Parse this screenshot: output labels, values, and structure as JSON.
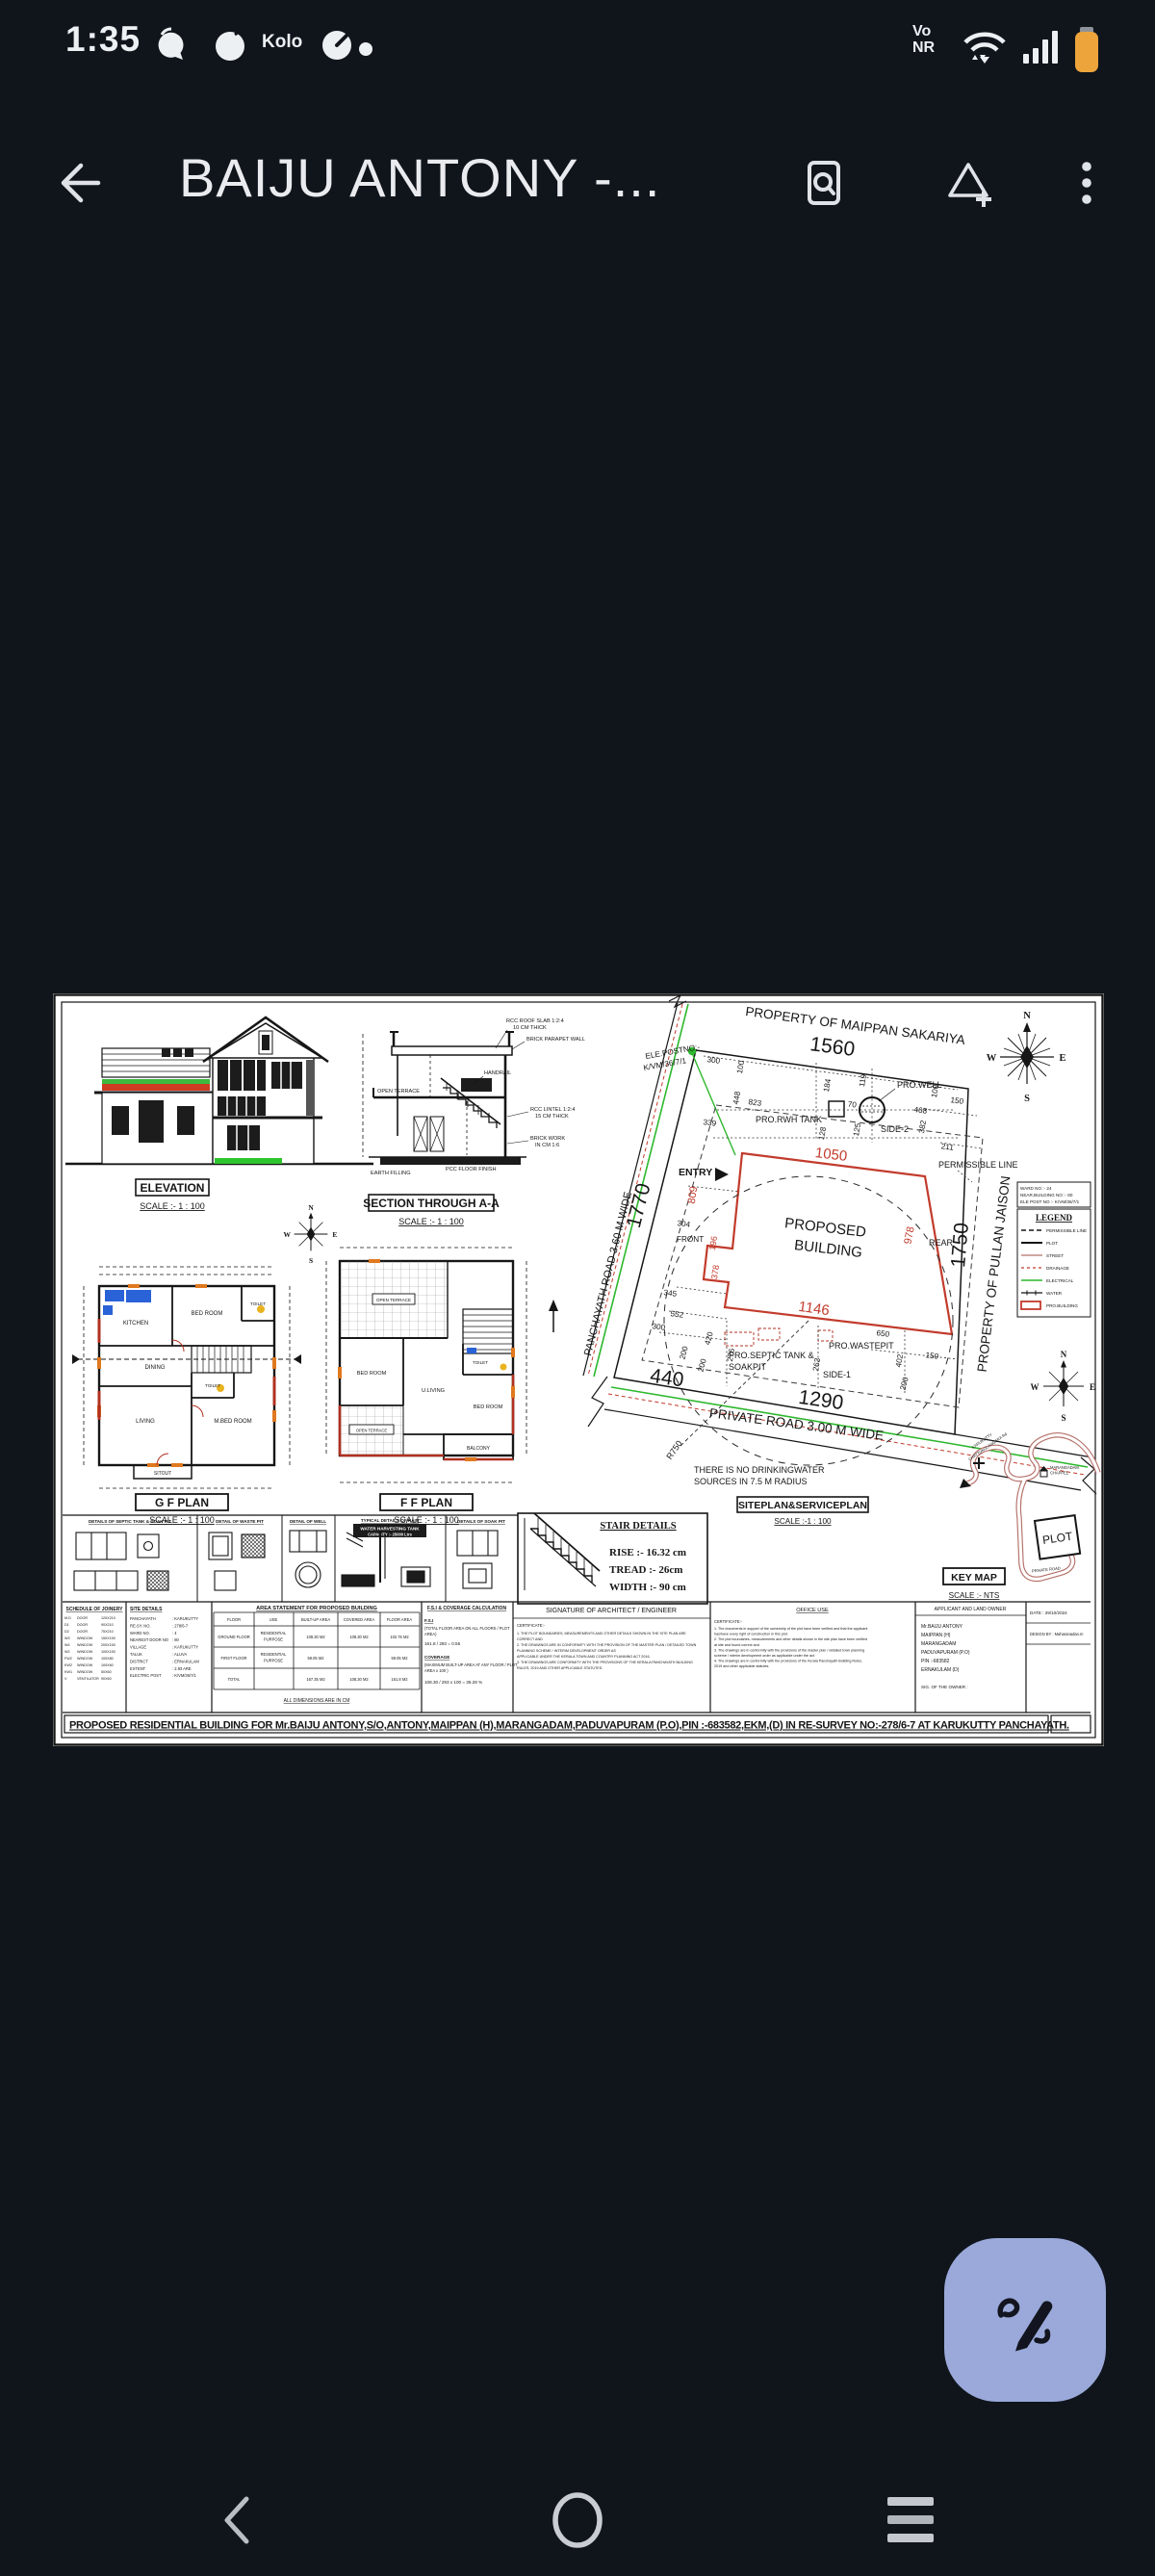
{
  "status_bar": {
    "time": "1:35",
    "carrier": "Kolo",
    "net1": "Vo",
    "net2": "NR"
  },
  "app_bar": {
    "title": "BAIJU ANTONY -..."
  },
  "compass": {
    "n": "N",
    "e": "E",
    "w": "W",
    "s": "S"
  },
  "sheet": {
    "el": {
      "title": "ELEVATION",
      "scale": "SCALE :- 1 : 100"
    },
    "sec": {
      "title": "SECTION THROUGH A-A",
      "scale": "SCALE :- 1 : 100",
      "a_roof1": "RCC ROOF SLAB 1:2:4",
      "a_roof2": "10 CM THICK",
      "a_par": "BRICK PARAPET WALL",
      "a_ter": "OPEN TERRACE",
      "a_hand": "HANDRAIL",
      "a_lin1": "RCC LINTEL 1:2:4",
      "a_lin2": "15 CM THICK",
      "a_brk1": "BRICK WORK",
      "a_brk2": "IN CM 1:6",
      "a_pcc": "PCC FLOOR FINISH",
      "a_earth": "EARTH FILLING"
    },
    "gf": {
      "title": "G F PLAN",
      "scale": "SCALE :- 1 : 100",
      "kitchen": "KITCHEN",
      "bed1": "BED ROOM",
      "toilet1": "TOILET",
      "dining": "DINING",
      "living": "LIVING",
      "mbed": "M.BED ROOM",
      "toilet2": "TOILET",
      "sitout": "SITOUT"
    },
    "ff": {
      "title": "F F PLAN",
      "scale": "SCALE :- 1 : 100",
      "ter1": "OPEN TERRACE",
      "ter2": "OPEN TERRACE",
      "bed1": "BED ROOM",
      "uliv": "U.LIVING",
      "toilet": "TOILET",
      "bed2": "BED ROOM",
      "balc": "BALCONY"
    },
    "site": {
      "prop_top": "PROPERTY OF MAIPPAN SAKARIYA",
      "prop_right": "PROPERTY OF PULLAN JAISON",
      "road_left": "PANCHAYATH ROAD 3.60 M WIDE",
      "road_bottom": "PRIVATE ROAD 3.00 M WIDE",
      "b1": "PROPOSED",
      "b2": "BUILDING",
      "entry": "ENTRY",
      "front": "FRONT",
      "rear": "REAR",
      "ele1": "ELE.POSTNO:-",
      "ele2": "K/VM/36/7/1",
      "well": "PRO.WELL",
      "rwh": "PRO.RWH TANK",
      "sep1": "PRO.SEPTIC TANK &",
      "sep2": "SOAKPIT",
      "waste": "PRO.WASTEPIT",
      "side1": "SIDE-1",
      "side2": "SIDE-2",
      "perm": "PERMISSIBLE LINE",
      "r750": "R750",
      "nw1": "THERE IS NO DRINKINGWATER",
      "nw2": "SOURCES IN 7.5 M RADIUS",
      "label": "SITEPLAN&SERVICEPLAN",
      "scale": "SCALE :-1 : 100",
      "d1560": "1560",
      "d1770": "1770",
      "d1750": "1750",
      "d1290": "1290",
      "d440": "440",
      "d1050": "1050",
      "d1146": "1146",
      "d809": "809",
      "d978": "978",
      "d196": "196",
      "d378": "378",
      "d300a": "300",
      "d100a": "100",
      "d448": "448",
      "d823": "823",
      "d184": "184",
      "d119": "119",
      "d70": "70",
      "d128": "128",
      "d125": "125",
      "d382": "382",
      "d468": "468",
      "d100b": "100",
      "d150a": "150",
      "d211": "211",
      "d339": "339",
      "d345": "345",
      "d552": "552",
      "d300b": "300",
      "d420": "420",
      "d200a": "200",
      "d200b": "200",
      "d276": "276",
      "d263": "263",
      "d650": "650",
      "d402": "402",
      "d150b": "150",
      "d200c": "200",
      "d304": "304"
    },
    "info": {
      "ward": "WARD NO :- 24",
      "near": "NEAR.BUILDING NO :- 80",
      "ele": "ELE POST NO :- K/VM/36/7/1"
    },
    "legend": {
      "title": "LEGEND",
      "i0": "PERMISSIBLE LINE",
      "i1": "PLOT",
      "i2": "STREET",
      "i3": "DRAINAGE",
      "i4": "ELECTRICAL",
      "i5": "WATER",
      "i6": "PRO.BUILDING"
    },
    "stair": {
      "title": "STAIR DETAILS",
      "rise": "RISE :- 16.32 cm",
      "tread": "TREAD :- 26cm",
      "width": "WIDTH :- 90 cm"
    },
    "keymap": {
      "title": "KEY MAP",
      "scale": "SCALE :- NTS",
      "plot": "PLOT",
      "ch1": "MARANGADAM",
      "ch2": "CHAPPEL",
      "rd1": "KARUKUTTY",
      "rd2": "CHATTUKULANGARA Rd",
      "rd3": "PRIVATE ROAD"
    },
    "det": {
      "t1": "DETAILS OF SEPTIC TANK & SOAK PIT",
      "t2": "DETAIL OF WASTE PIT",
      "t3": "DETAIL OF WELL",
      "t4a": "TYPICAL DETAILS OF RAIN",
      "t4b": "WATER HARVESTING TANK",
      "t4c": "CAPACITY :- 25000 Ltrs",
      "t5": "DETAILS OF SOAK PIT"
    },
    "joinery": {
      "title": "SCHEDULE OF JOINERY",
      "rows": [
        [
          "M.D",
          "DOOR",
          "120X210"
        ],
        [
          "D1",
          "DOOR",
          "90X210"
        ],
        [
          "D2",
          "DOOR",
          "75X210"
        ],
        [
          "W3",
          "WINDOW",
          "150X150"
        ],
        [
          "W4",
          "WINDOW",
          "200X150"
        ],
        [
          "W2",
          "WINDOW",
          "100X150"
        ],
        [
          "FW2",
          "WINDOW",
          "100X80"
        ],
        [
          "KW2",
          "WINDOW",
          "100X60"
        ],
        [
          "KW1",
          "WINDOW",
          "50X60"
        ],
        [
          "V",
          "VENTILATOR",
          "90X60"
        ]
      ]
    },
    "sited": {
      "title": "SITE DETAILS",
      "rows": [
        [
          "PANCHAYATH",
          ": KARUKUTTY"
        ],
        [
          "RE-SY. NO.",
          ": 278/6-7"
        ],
        [
          "WARD NO.",
          ": 4"
        ],
        [
          "NEAREST DOOR NO",
          ": 80"
        ],
        [
          "VILLAGE",
          ": KARUKUTTY"
        ],
        [
          "TALUK",
          ": ALUVA"
        ],
        [
          "DISTRICT",
          ": ERNAKULAM"
        ],
        [
          "EXTENT",
          ": 2.93 ARE"
        ],
        [
          "ELECTRIC POST",
          ": K/VM/36/7/1"
        ]
      ]
    },
    "area": {
      "title": "AREA STATEMENT FOR PROPOSED BUILDING",
      "h": [
        "FLOOR",
        "USE",
        "BUILT-UP AREA",
        "COVERED AREA",
        "FLOOR AREA"
      ],
      "r0": {
        "floor": "GROUND FLOOR",
        "use1": "RESIDENTIAL",
        "use2": "PURPOSE",
        "built": "108.30 M2",
        "covered": "108.30 M2",
        "farea": "102.75 M2"
      },
      "r1": {
        "floor": "FIRST FLOOR",
        "use1": "RESIDENTIAL",
        "use2": "PURPOSE",
        "built": "59.05 M2",
        "covered": "",
        "farea": "59.05 M2"
      },
      "r2": {
        "floor": "TOTAL",
        "use1": "",
        "use2": "",
        "built": "167.35 M2",
        "covered": "108.30 M2",
        "farea": "161.8 M2"
      },
      "footer": "ALL DIMENSIONS ARE IN CM"
    },
    "fsi": {
      "title": "F.S.I & COVERAGE CALCULATION",
      "l1": "F.S.I",
      "l2": "(TOTAL FLOOR AREA ON ALL FLOORS / PLOT",
      "l3": "AREA)",
      "l4": "161.8 / 293 = 0.55",
      "l5": "COVERAGE",
      "l6": "(MAXIMUM BUILT-UP AREA AT ANY FLOOR / PLOT",
      "l7": "AREA x 100 )",
      "l8": "108.30 / 293 x 100 = 36.28 %"
    },
    "sign": {
      "title": "SIGNATURE OF ARCHITECT / ENGINEER",
      "cert": "CERTIFICATE:-",
      "lines": [
        "1. THE PLOT BOUNDARIES, MEASUREMENTS AND OTHER DETAILS SHOWN IN THE SITE PLAN ARE",
        "CORRECT AND",
        "2. THE DRAWINGS ARE IN CONFORMITY WITH THE PROVISION OF THE MASTER PLAN / DETAILED TOWN",
        "PLANNING SCHEME / INTERIM DEVELOPMENT ORDER AS",
        "APPLICABLE UNDER THE KERALA TOWN AND COUNTRY PLANNING ACT 2016.",
        "3. THE DRAWINGS ARE CONFORMITY WITH THE PROVISIONS OF THE KERALA PANCHAYATH BUILDING",
        "RULES, 2019 AND OTHER APPLICABLE STATUTES."
      ]
    },
    "office": {
      "title": "OFFICE USE",
      "cert": "CERTIFICATE:-",
      "lines": [
        "1. The documents in support of the ownership of the plot have been verified and that the applicant",
        "has/have every right of construction in this plot.",
        "2. The plot boundaries, measurements and other details shown in the site plan have been verified",
        "at site and found correct and",
        "3. The drawings are in conformity with the provisions of the master plan / detailed town planning",
        "scheme / interim development order as applicable under the act.",
        "4. The drawings are in conformity with the provisions of the Kerala Panchayath Building Rules,",
        "2019 and other applicable statutes."
      ]
    },
    "app": {
      "title": "APPLICANT AND LAND OWNER",
      "l0": "Mr.BAIJU ANTONY",
      "l1": "MAIPPAN (H)",
      "l2": "MARANGADAM",
      "l3": "PADUVAPURAM (P.O)",
      "l4": "PIN :-683582",
      "l5": "ERNAKULAM (D)",
      "sig": "SIG. OF THE OWNER :"
    },
    "datebox": {
      "date": "DATE : 29/10/2024",
      "design": "DESIGN BY : Maharanadan.m"
    },
    "caption": "PROPOSED RESIDENTIAL BUILDING FOR Mr.BAIJU ANTONY,S/O,ANTONY,MAIPPAN (H),MARANGADAM,PADUVAPURAM (P.O),PIN :-683582,EKM,(D)  IN RE-SURVEY NO:-278/6-7 AT  KARUKUTTY PANCHAYATH."
  }
}
